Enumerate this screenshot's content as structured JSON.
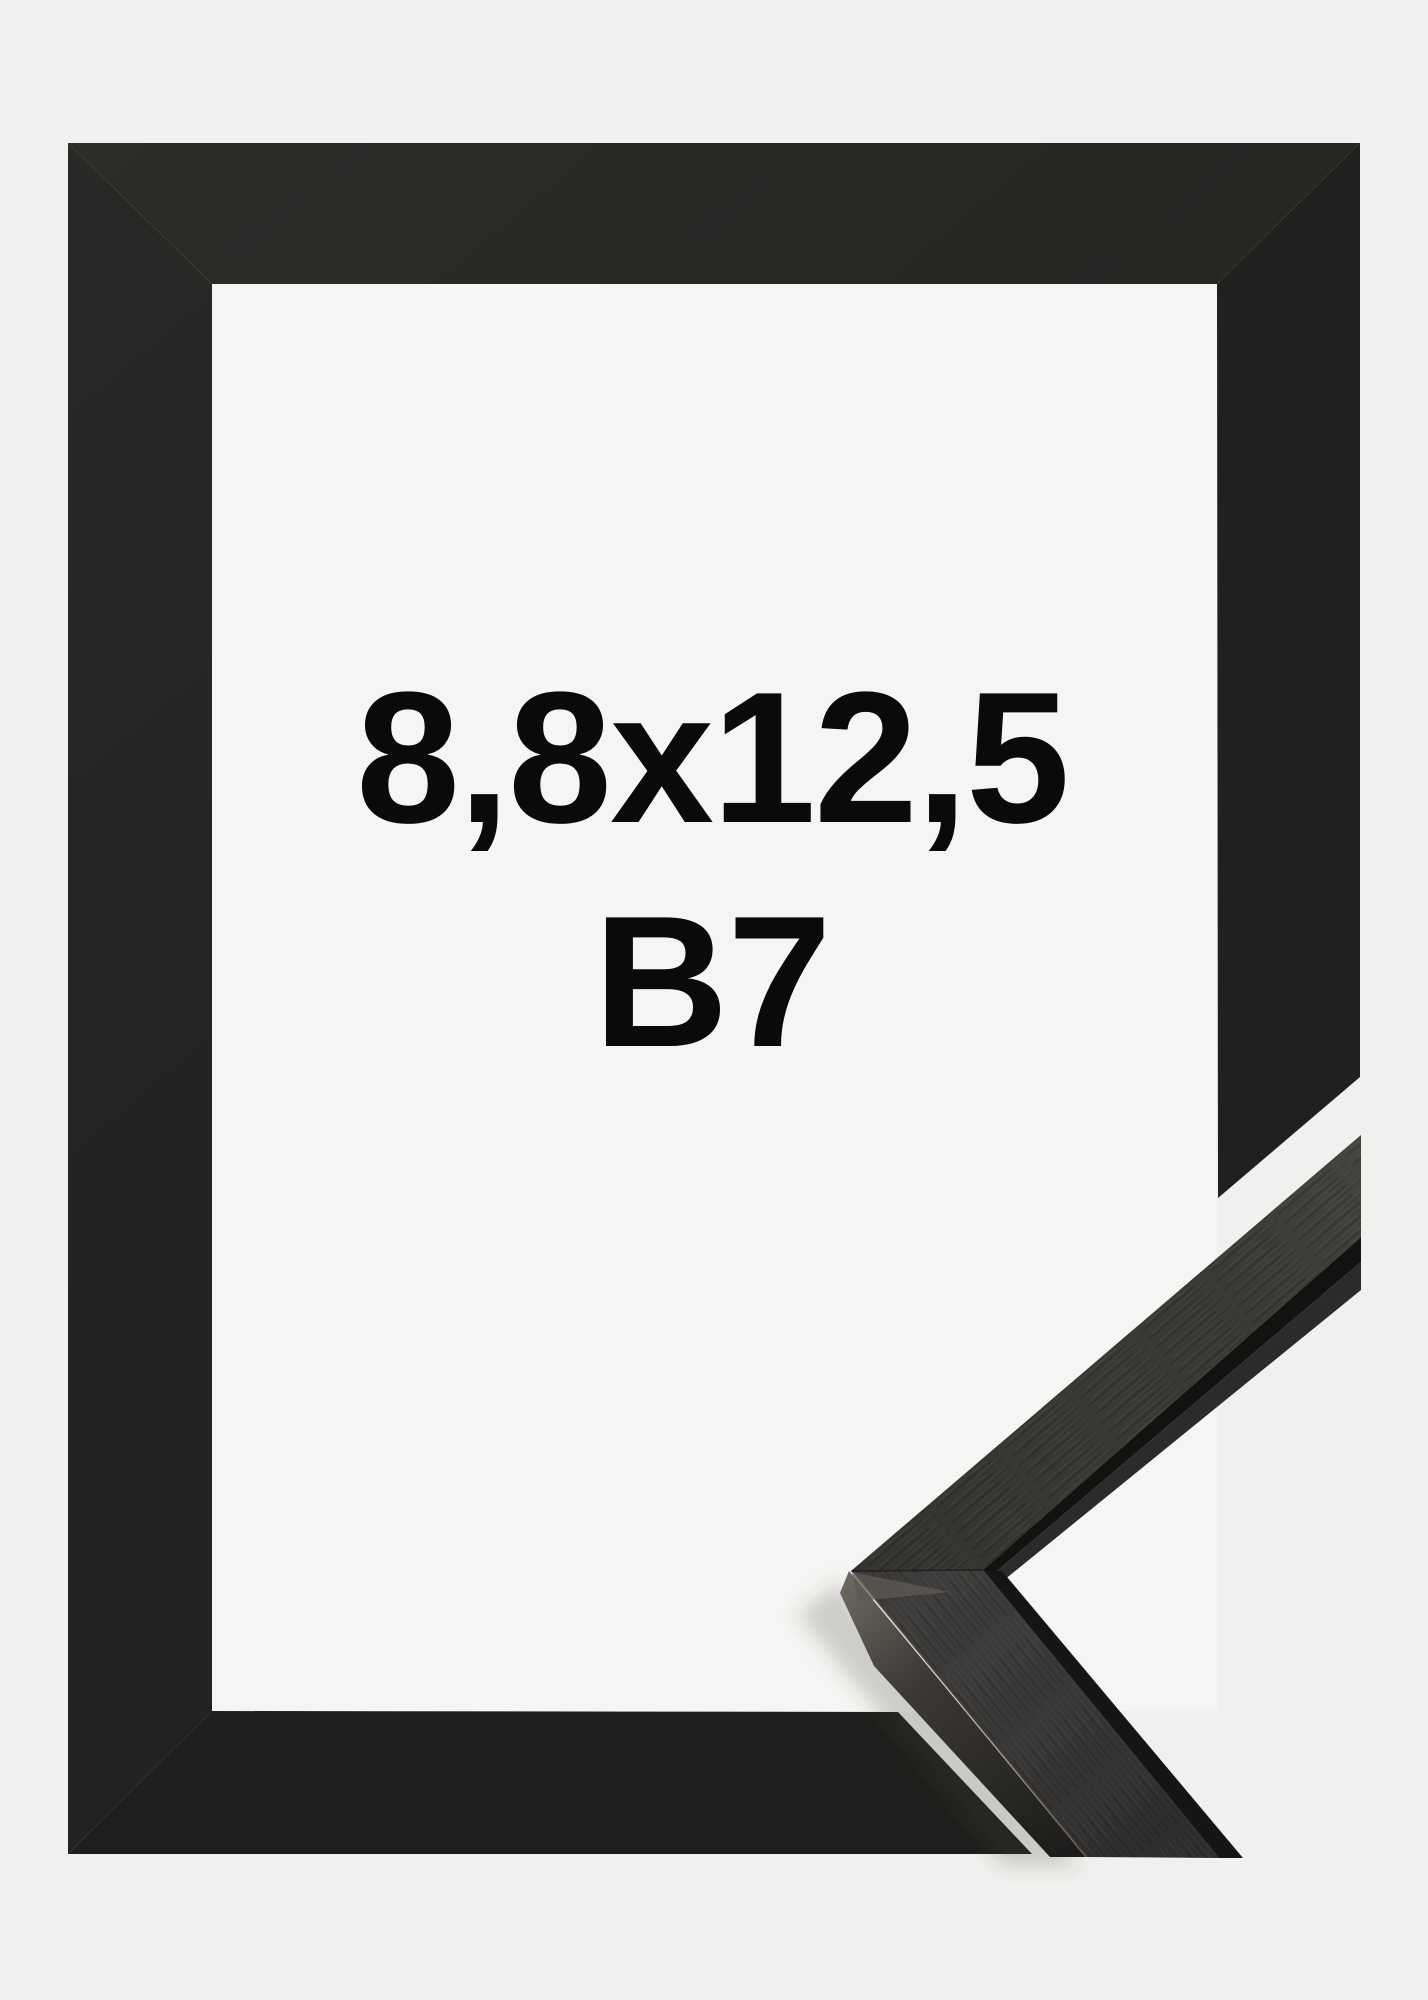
{
  "product": {
    "size_label": "8,8x12,5",
    "format_label": "B7"
  },
  "colors": {
    "background": "#f1f0ee",
    "window": "#f6f5f3",
    "frame_top": "#272522",
    "frame_left": "#242220",
    "frame_right": "#22201f",
    "frame_bottom": "#1f1e1c",
    "text": "#0a0a0a",
    "moulding_face_upper": "#3b3936",
    "moulding_face_lower": "#343230",
    "moulding_groove": "#131211",
    "moulding_lip": "#2d2b29",
    "moulding_edge_strip": "#161514",
    "moulding_sheen": "#5c5852"
  }
}
